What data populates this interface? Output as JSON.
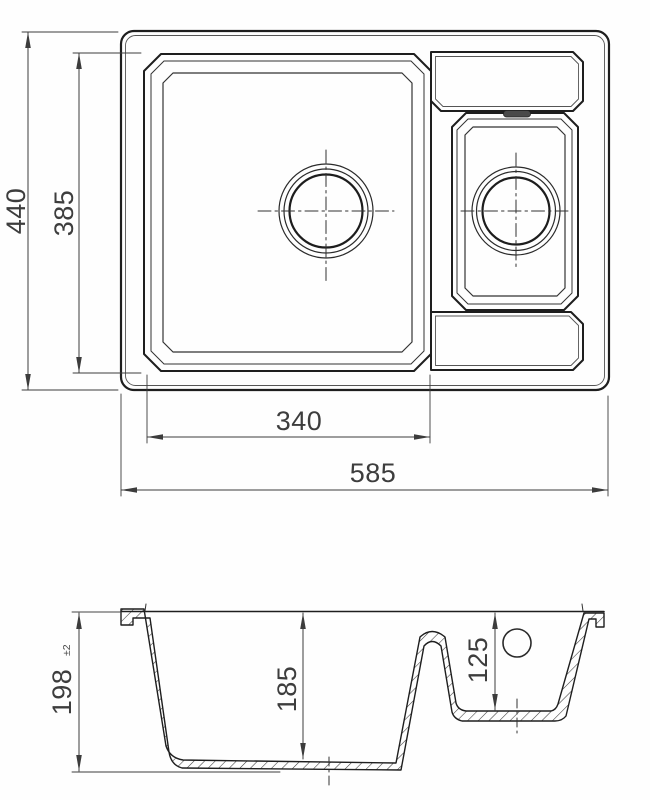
{
  "page": {
    "background": "#fefefe",
    "line_color": "#242424",
    "text_color": "#3d3d3d"
  },
  "drawing": {
    "type": "sink-technical-drawing",
    "top_view": {
      "overall_width": "585",
      "overall_depth": "440",
      "main_bowl_width": "340",
      "main_bowl_depth": "385"
    },
    "section_view": {
      "overall_height": "198",
      "overall_height_tolerance": "±2",
      "main_bowl_depth": "185",
      "secondary_bowl_depth": "125"
    }
  }
}
